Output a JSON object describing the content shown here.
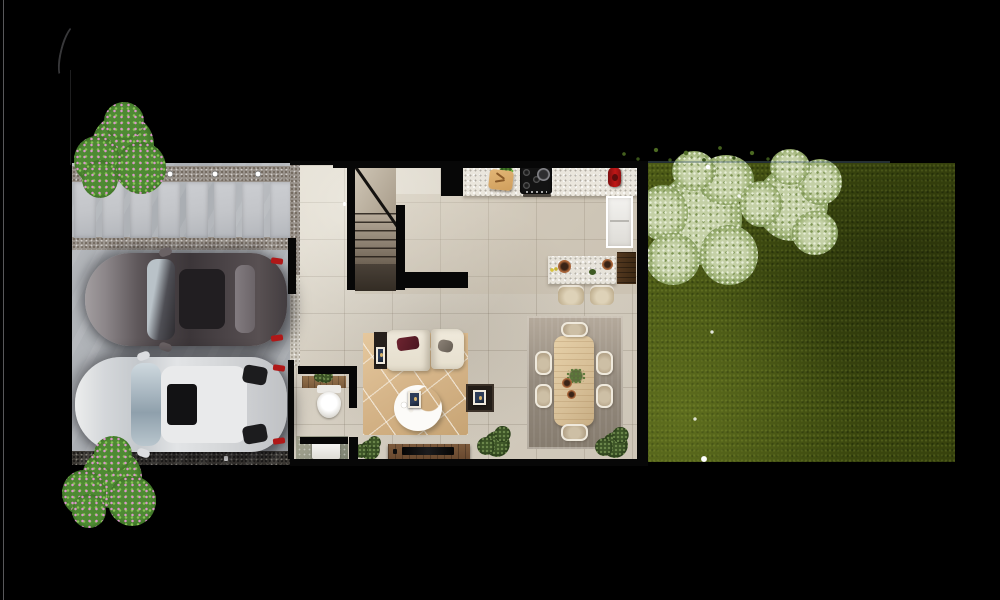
{
  "scene": {
    "label": "Top-down 3D architectural render of a narrow row house: paved driveway with two parked cars on the left, furnished ground-floor interior in the middle (stairs, kitchen, island with stools, powder room, laundry, living room, dining room), and a grass backyard with two trees on the right"
  },
  "palette": {
    "background": "#000000",
    "driveway_concrete": "#b5b8bc",
    "paver": "#c3c5c9",
    "gravel": "#98918a",
    "gravel_dark": "#3b3833",
    "floor_tile": "#d3ccbf",
    "kitchen_counter": "#eae6dd",
    "wall": "#070707",
    "stairs_dark": "#332c24",
    "rug_living": "#d5b488",
    "rug_dining": "#948a7d",
    "sofa_cream": "#e4ddcc",
    "wood_table": "#d8c098",
    "tv_console": "#64452c",
    "grass_dark": "#3c490f",
    "grass_light": "#4c5a16",
    "tree_foliage": "#9db174",
    "tree_highlight": "#c4d0a6",
    "bush_green": "#4e8a33",
    "bush_flower": "#dc96cc",
    "car_dark_body": "#4a4346",
    "car_light_body": "#e2e4e6",
    "taillight": "#b01818",
    "kettle_red": "#c01616"
  },
  "driveway": {
    "paver_count": 8,
    "recessed_light_count": 3,
    "car_count": 2
  },
  "interior": {
    "dining_chair_count": 6,
    "bar_stool_count": 2
  },
  "garden": {
    "tree_count": 2
  }
}
